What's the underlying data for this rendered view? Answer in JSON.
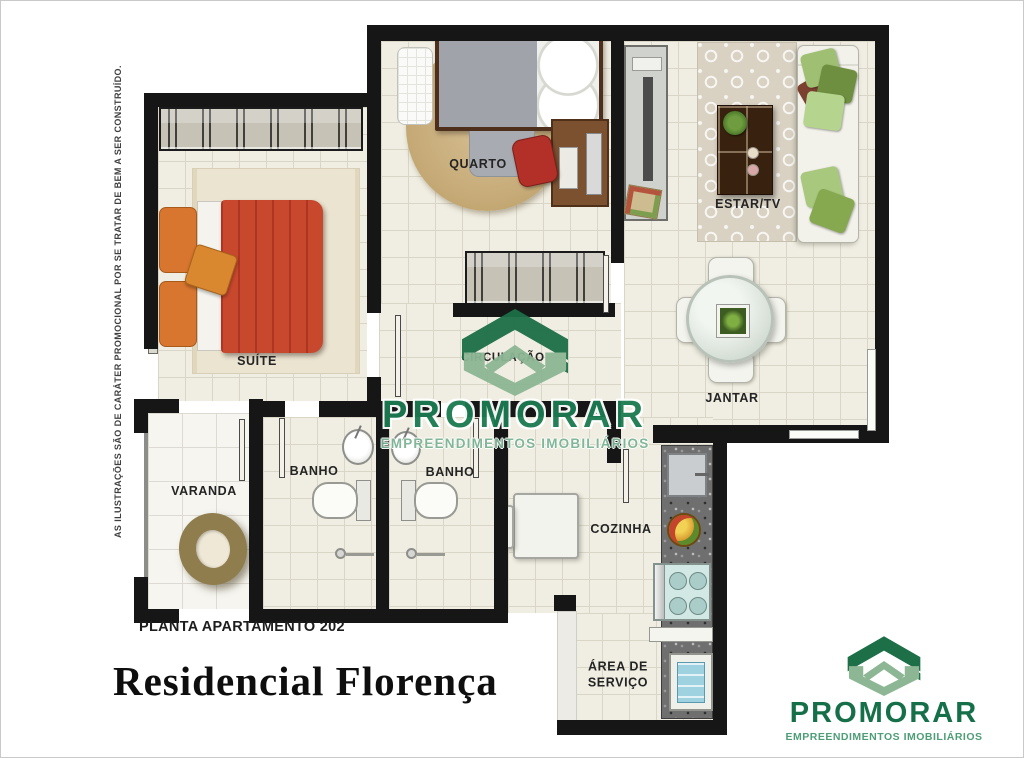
{
  "disclaimer": "AS ILUSTRAÇÕES SÃO DE CARÁTER PROMOCIONAL POR SE TRATAR DE BEM A SER CONSTRUÍDO.",
  "plan": {
    "label": "PLANTA APARTAMENTO 202",
    "title": "Residencial Florença"
  },
  "rooms": {
    "suite": "SUÍTE",
    "quarto": "QUARTO",
    "estar_tv": "ESTAR/TV",
    "jantar": "JANTAR",
    "circulacao": "CIRCULAÇÃO",
    "varanda": "VARANDA",
    "banho_suite": "BANHO",
    "banho_social": "BANHO",
    "cozinha": "COZINHA",
    "area_servico": [
      "ÁREA DE",
      "SERVIÇO"
    ]
  },
  "brand": {
    "name": "PROMORAR",
    "tagline": "EMPREENDIMENTOS IMOBILIÁRIOS",
    "colors": {
      "dark_green": "#1C6F47",
      "light_green": "#8CB694"
    }
  }
}
